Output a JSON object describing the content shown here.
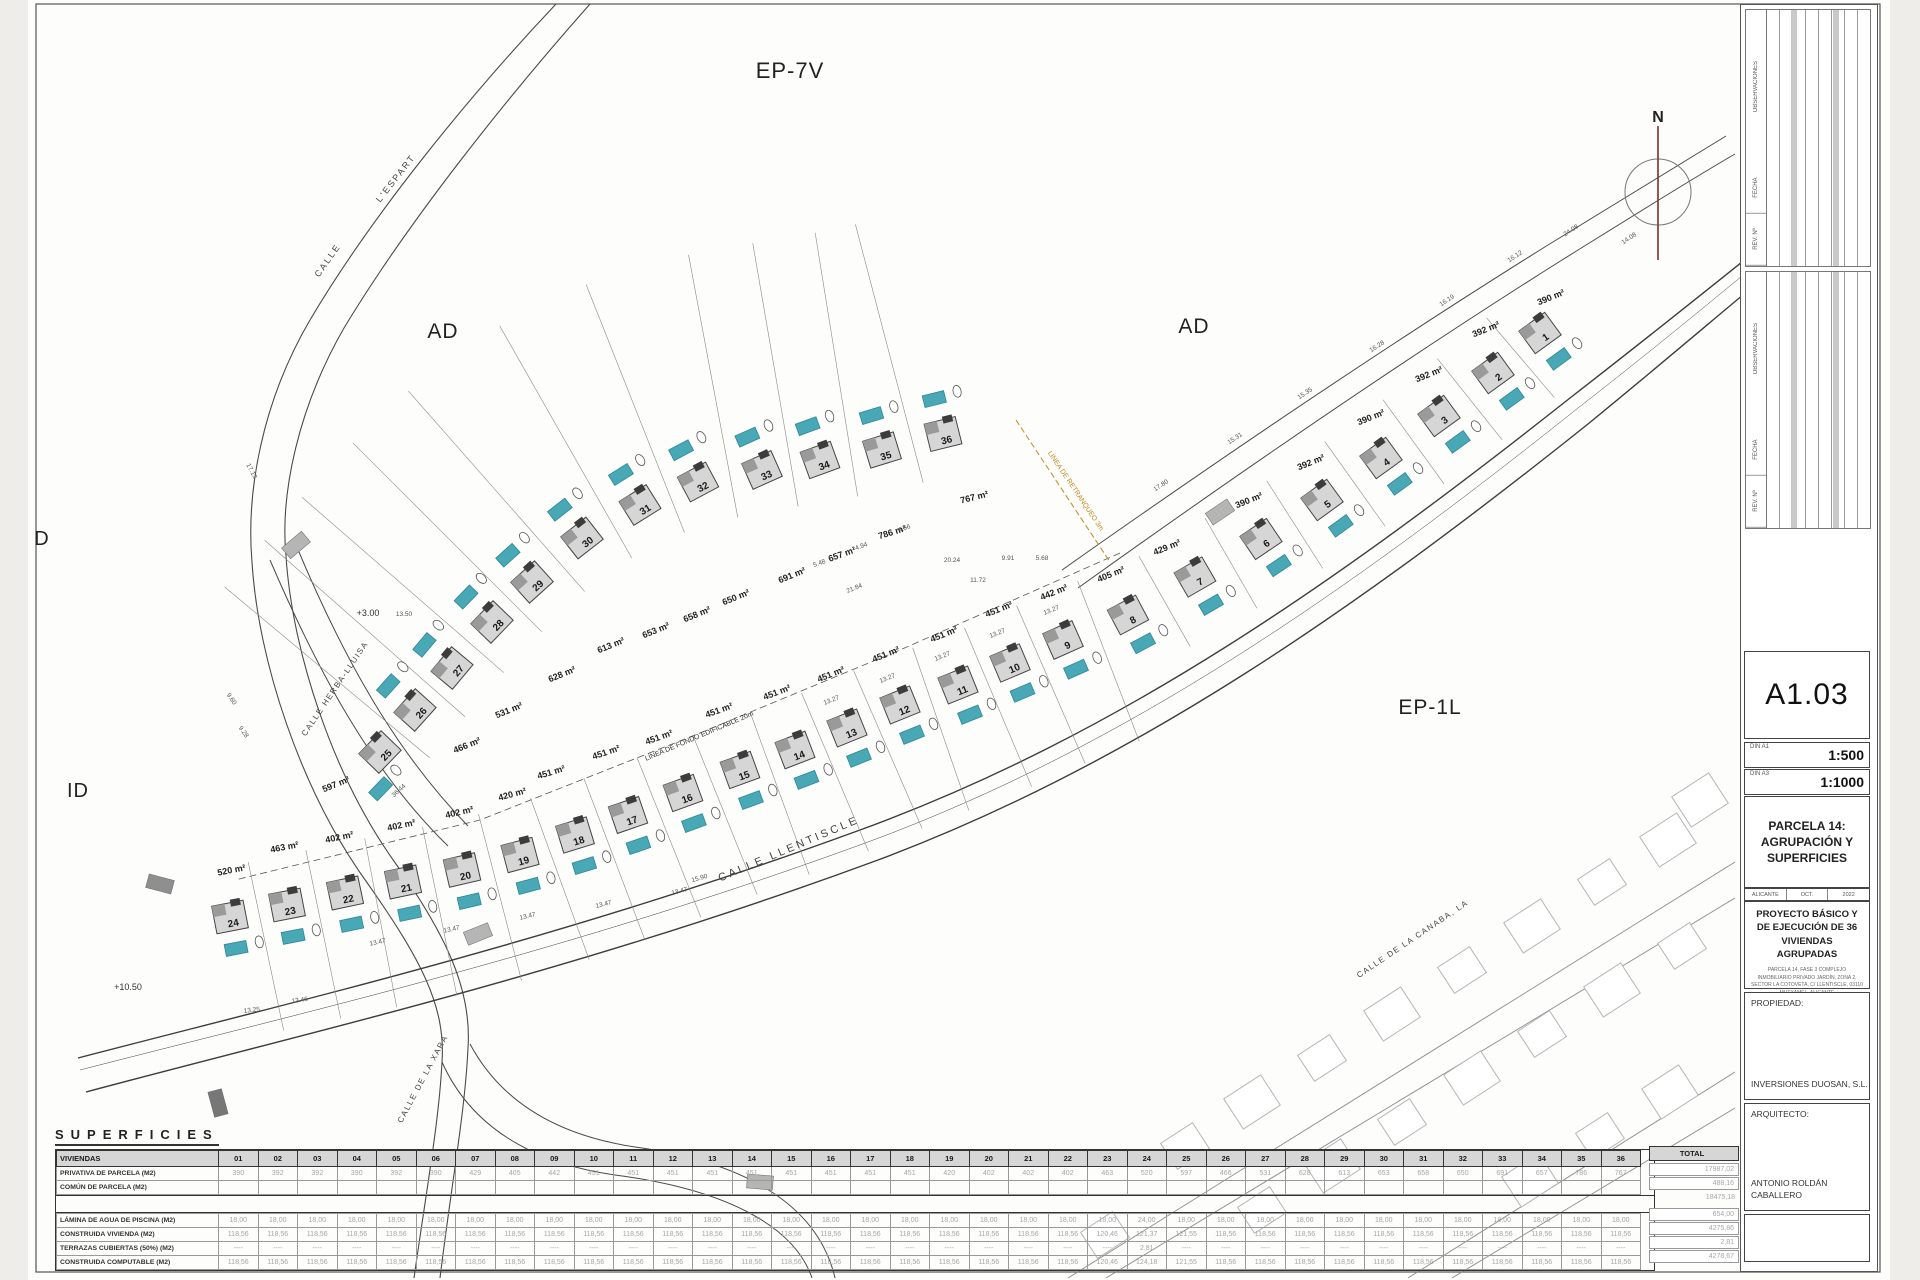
{
  "sheet": {
    "code": "A1.03",
    "format_a1": "DIN A1",
    "scale_a1": "1:500",
    "format_a3": "DIN A3",
    "scale_a3": "1:1000",
    "drawing_title": "PARCELA 14: AGRUPACIÓN Y SUPERFICIES",
    "city": "ALICANTE",
    "month": "OCT.",
    "year": "2022",
    "project": "PROYECTO BÁSICO Y DE EJECUCIÓN DE 36 VIVIENDAS AGRUPADAS",
    "project_detail": "PARCELA 14, FASE 3 COMPLEJO INMOBILIARIO PRIVADO JARDÍN, ZONA 2, SECTOR LA COTOVETA, C/ LLENTISCLE, 03110 MUTXAMEL, ALICANTE",
    "propiedad_label": "PROPIEDAD:",
    "propiedad": "INVERSIONES DUOSAN, S.L.",
    "arquitecto_label": "ARQUITECTO:",
    "arquitecto": "ANTONIO ROLDÁN CABALLERO"
  },
  "north": {
    "label": "N"
  },
  "rev_labels": [
    "OBSERVACIONES",
    "FECHA",
    "REV. Nº"
  ],
  "zones": [
    {
      "label": "EP-7V",
      "x": 790,
      "y": 78,
      "size": 22
    },
    {
      "label": "AD",
      "x": 443,
      "y": 338,
      "size": 21
    },
    {
      "label": "AD",
      "x": 1194,
      "y": 333,
      "size": 21
    },
    {
      "label": "EP-1L",
      "x": 1430,
      "y": 714,
      "size": 21
    },
    {
      "label": "ID",
      "x": 78,
      "y": 797,
      "size": 20
    },
    {
      "label": "D",
      "x": 42,
      "y": 545,
      "size": 20
    }
  ],
  "streets": [
    {
      "label": "CALLE",
      "x": 330,
      "y": 262,
      "r": -55,
      "size": 9,
      "ls": 2
    },
    {
      "label": "L'ESPART",
      "x": 398,
      "y": 180,
      "r": -52,
      "size": 9,
      "ls": 2
    },
    {
      "label": "CALLE HERBA-LLUISA",
      "x": 337,
      "y": 690,
      "r": -56,
      "size": 8,
      "ls": 1.5
    },
    {
      "label": "CALLE LLENTISCLE",
      "x": 790,
      "y": 852,
      "r": -23,
      "size": 11,
      "ls": 3
    },
    {
      "label": "CALLE DE LA XARA",
      "x": 425,
      "y": 1080,
      "r": -62,
      "size": 8,
      "ls": 1.5
    },
    {
      "label": "CALLE DE LA CANABA, LA",
      "x": 1414,
      "y": 941,
      "r": -34,
      "size": 8,
      "ls": 1.5
    }
  ],
  "annotations": {
    "retranqueo": {
      "label": "LÍNEA DE RETRANQUEO 3m",
      "x": 1074,
      "y": 492,
      "r": 56,
      "color": "#bf8a1e"
    },
    "fondo": {
      "label": "LÍNEA DE FONDO EDIFICABLE 20m",
      "x": 700,
      "y": 738,
      "r": -23
    },
    "levels": [
      {
        "label": "+3.00",
        "x": 368,
        "y": 616
      },
      {
        "label": "+10.50",
        "x": 128,
        "y": 990
      }
    ]
  },
  "houses": [
    {
      "n": "1",
      "x": 1540,
      "y": 333,
      "r": -36,
      "p": "s",
      "area": "390 m²",
      "ax": 1552,
      "ay": 300
    },
    {
      "n": "2",
      "x": 1493,
      "y": 373,
      "r": -36,
      "p": "s",
      "area": "392 m²",
      "ax": 1487,
      "ay": 332
    },
    {
      "n": "3",
      "x": 1439,
      "y": 416,
      "r": -36,
      "p": "s",
      "area": "392 m²",
      "ax": 1430,
      "ay": 377
    },
    {
      "n": "4",
      "x": 1381,
      "y": 458,
      "r": -36,
      "p": "s",
      "area": "390 m²",
      "ax": 1372,
      "ay": 420
    },
    {
      "n": "5",
      "x": 1322,
      "y": 500,
      "r": -36,
      "p": "s",
      "area": "392 m²",
      "ax": 1312,
      "ay": 465
    },
    {
      "n": "6",
      "x": 1261,
      "y": 539,
      "r": -34,
      "p": "s",
      "area": "390 m²",
      "ax": 1250,
      "ay": 503
    },
    {
      "n": "7",
      "x": 1195,
      "y": 577,
      "r": -30,
      "p": "s",
      "area": "429 m²",
      "ax": 1168,
      "ay": 550
    },
    {
      "n": "8",
      "x": 1128,
      "y": 615,
      "r": -28,
      "p": "s",
      "area": "405 m²",
      "ax": 1112,
      "ay": 577
    },
    {
      "n": "9",
      "x": 1063,
      "y": 640,
      "r": -24,
      "p": "s",
      "area": "442 m²",
      "ax": 1055,
      "ay": 595
    },
    {
      "n": "10",
      "x": 1010,
      "y": 663,
      "r": -23,
      "p": "s",
      "area": "451 m²",
      "ax": 1000,
      "ay": 612
    },
    {
      "n": "11",
      "x": 958,
      "y": 685,
      "r": -22,
      "p": "s",
      "area": "451 m²",
      "ax": 945,
      "ay": 637
    },
    {
      "n": "12",
      "x": 900,
      "y": 705,
      "r": -22,
      "p": "s",
      "area": "451 m²",
      "ax": 887,
      "ay": 657
    },
    {
      "n": "13",
      "x": 847,
      "y": 728,
      "r": -22,
      "p": "s",
      "area": "451 m²",
      "ax": 832,
      "ay": 677
    },
    {
      "n": "14",
      "x": 795,
      "y": 750,
      "r": -21,
      "p": "s",
      "area": "451 m²",
      "ax": 778,
      "ay": 695
    },
    {
      "n": "15",
      "x": 740,
      "y": 770,
      "r": -20,
      "p": "s",
      "area": "451 m²",
      "ax": 720,
      "ay": 713
    },
    {
      "n": "16",
      "x": 683,
      "y": 793,
      "r": -20,
      "p": "s",
      "area": "451 m²",
      "ax": 660,
      "ay": 740
    },
    {
      "n": "17",
      "x": 628,
      "y": 815,
      "r": -19,
      "p": "s",
      "area": "451 m²",
      "ax": 607,
      "ay": 755
    },
    {
      "n": "18",
      "x": 575,
      "y": 835,
      "r": -17,
      "p": "s",
      "area": "451 m²",
      "ax": 552,
      "ay": 775
    },
    {
      "n": "19",
      "x": 520,
      "y": 855,
      "r": -15,
      "p": "s",
      "area": "420 m²",
      "ax": 513,
      "ay": 797
    },
    {
      "n": "20",
      "x": 462,
      "y": 870,
      "r": -13,
      "p": "s",
      "area": "402 m²",
      "ax": 460,
      "ay": 815
    },
    {
      "n": "21",
      "x": 403,
      "y": 882,
      "r": -12,
      "p": "s",
      "area": "402 m²",
      "ax": 402,
      "ay": 828
    },
    {
      "n": "22",
      "x": 345,
      "y": 893,
      "r": -12,
      "p": "s",
      "area": "402 m²",
      "ax": 340,
      "ay": 840
    },
    {
      "n": "23",
      "x": 287,
      "y": 905,
      "r": -11,
      "p": "s",
      "area": "463 m²",
      "ax": 285,
      "ay": 850
    },
    {
      "n": "24",
      "x": 230,
      "y": 917,
      "r": -11,
      "p": "s",
      "area": "520 m²",
      "ax": 232,
      "ay": 873
    },
    {
      "n": "25",
      "x": 380,
      "y": 752,
      "r": -46,
      "p": "sw",
      "area": "597 m²",
      "ax": 337,
      "ay": 787
    },
    {
      "n": "26",
      "x": 415,
      "y": 710,
      "r": -48,
      "p": "nw",
      "area": "466 m²",
      "ax": 468,
      "ay": 748
    },
    {
      "n": "27",
      "x": 452,
      "y": 668,
      "r": -50,
      "p": "nw",
      "area": "531 m²",
      "ax": 510,
      "ay": 713
    },
    {
      "n": "28",
      "x": 492,
      "y": 622,
      "r": -46,
      "p": "nw",
      "area": "628 m²",
      "ax": 563,
      "ay": 677
    },
    {
      "n": "29",
      "x": 532,
      "y": 582,
      "r": -42,
      "p": "nw",
      "area": "613 m²",
      "ax": 612,
      "ay": 648
    },
    {
      "n": "30",
      "x": 582,
      "y": 538,
      "r": -38,
      "p": "nw",
      "area": "653 m²",
      "ax": 657,
      "ay": 633
    },
    {
      "n": "31",
      "x": 640,
      "y": 505,
      "r": -32,
      "p": "nw",
      "area": "658 m²",
      "ax": 698,
      "ay": 617
    },
    {
      "n": "32",
      "x": 698,
      "y": 482,
      "r": -28,
      "p": "nw",
      "area": "650 m²",
      "ax": 737,
      "ay": 600
    },
    {
      "n": "33",
      "x": 762,
      "y": 470,
      "r": -24,
      "p": "nw",
      "area": "691 m²",
      "ax": 793,
      "ay": 578
    },
    {
      "n": "34",
      "x": 820,
      "y": 460,
      "r": -20,
      "p": "nw",
      "area": "657 m²",
      "ax": 843,
      "ay": 557
    },
    {
      "n": "35",
      "x": 882,
      "y": 450,
      "r": -17,
      "p": "nw",
      "area": "786 m²",
      "ax": 893,
      "ay": 535
    },
    {
      "n": "36",
      "x": 943,
      "y": 434,
      "r": -14,
      "p": "nw",
      "area": "767 m²",
      "ax": 975,
      "ay": 500
    }
  ],
  "dims": [
    {
      "t": "13.47",
      "x": 378,
      "y": 944,
      "r": -12
    },
    {
      "t": "13.47",
      "x": 452,
      "y": 931,
      "r": -12
    },
    {
      "t": "13.47",
      "x": 528,
      "y": 918,
      "r": -13
    },
    {
      "t": "13.47",
      "x": 604,
      "y": 906,
      "r": -14
    },
    {
      "t": "13.47",
      "x": 680,
      "y": 893,
      "r": -15
    },
    {
      "t": "13.46",
      "x": 300,
      "y": 1002,
      "r": -8
    },
    {
      "t": "13.25",
      "x": 252,
      "y": 1012,
      "r": -6
    },
    {
      "t": "15.90",
      "x": 700,
      "y": 880,
      "r": -16
    },
    {
      "t": "13.27",
      "x": 832,
      "y": 702,
      "r": -22
    },
    {
      "t": "13.27",
      "x": 888,
      "y": 680,
      "r": -22
    },
    {
      "t": "13.27",
      "x": 943,
      "y": 658,
      "r": -22
    },
    {
      "t": "13.27",
      "x": 998,
      "y": 635,
      "r": -22
    },
    {
      "t": "13.27",
      "x": 1052,
      "y": 612,
      "r": -22
    },
    {
      "t": "16.12",
      "x": 1516,
      "y": 258,
      "r": -34
    },
    {
      "t": "16.19",
      "x": 1448,
      "y": 302,
      "r": -34
    },
    {
      "t": "16.28",
      "x": 1378,
      "y": 348,
      "r": -34
    },
    {
      "t": "15.35",
      "x": 1306,
      "y": 395,
      "r": -34
    },
    {
      "t": "15.31",
      "x": 1236,
      "y": 440,
      "r": -34
    },
    {
      "t": "17.80",
      "x": 1162,
      "y": 487,
      "r": -34
    },
    {
      "t": "24.08",
      "x": 1572,
      "y": 232,
      "r": -34
    },
    {
      "t": "14.08",
      "x": 1630,
      "y": 240,
      "r": -34
    },
    {
      "t": "20.24",
      "x": 952,
      "y": 562,
      "r": 0
    },
    {
      "t": "9.91",
      "x": 1008,
      "y": 560,
      "r": 0
    },
    {
      "t": "5.68",
      "x": 1042,
      "y": 560,
      "r": 0
    },
    {
      "t": "11.72",
      "x": 978,
      "y": 582,
      "r": 0
    },
    {
      "t": "21.84",
      "x": 855,
      "y": 590,
      "r": -22
    },
    {
      "t": "36.44",
      "x": 400,
      "y": 792,
      "r": -42
    },
    {
      "t": "13.50",
      "x": 404,
      "y": 616,
      "r": 0
    },
    {
      "t": "4.56",
      "x": 905,
      "y": 530,
      "r": -20
    },
    {
      "t": "4.94",
      "x": 862,
      "y": 548,
      "r": -20
    },
    {
      "t": "5.48",
      "x": 820,
      "y": 565,
      "r": -20
    },
    {
      "t": "9.28",
      "x": 242,
      "y": 733,
      "r": 55
    },
    {
      "t": "9.60",
      "x": 230,
      "y": 700,
      "r": 55
    },
    {
      "t": "17.13",
      "x": 250,
      "y": 472,
      "r": 62
    }
  ],
  "table": {
    "title": "SUPERFICIES",
    "header_label": "VIVIENDAS",
    "total_label": "TOTAL",
    "columns": [
      "01",
      "02",
      "03",
      "04",
      "05",
      "06",
      "07",
      "08",
      "09",
      "10",
      "11",
      "12",
      "13",
      "14",
      "15",
      "16",
      "17",
      "18",
      "19",
      "20",
      "21",
      "22",
      "23",
      "24",
      "25",
      "26",
      "27",
      "28",
      "29",
      "30",
      "31",
      "32",
      "33",
      "34",
      "35",
      "36"
    ],
    "rows": [
      {
        "label": "PRIVATIVA DE PARCELA (M2)",
        "total": "17987,02",
        "values": [
          "390",
          "392",
          "392",
          "390",
          "392",
          "390",
          "429",
          "405",
          "442",
          "451",
          "451",
          "451",
          "451",
          "451",
          "451",
          "451",
          "451",
          "451",
          "420",
          "402",
          "402",
          "402",
          "463",
          "520",
          "597",
          "466",
          "531",
          "628",
          "613",
          "653",
          "658",
          "650",
          "691",
          "657",
          "786",
          "767"
        ]
      },
      {
        "label": "COMÚN DE PARCELA (M2)",
        "total": "488,16",
        "values": [
          "",
          "",
          "",
          "",
          "",
          "",
          "",
          "",
          "",
          "",
          "",
          "",
          "",
          "",
          "",
          "",
          "",
          "",
          "",
          "",
          "",
          "",
          "",
          "",
          "",
          "",
          "",
          "",
          "",
          "",
          "",
          "",
          "",
          "",
          "",
          ""
        ]
      }
    ],
    "subtotal": "18475,18",
    "rows2": [
      {
        "label": "LÁMINA DE AGUA DE PISCINA (M2)",
        "total": "654,00",
        "values": [
          "18,00",
          "18,00",
          "18,00",
          "18,00",
          "18,00",
          "18,00",
          "18,00",
          "18,00",
          "18,00",
          "18,00",
          "18,00",
          "18,00",
          "18,00",
          "18,00",
          "18,00",
          "18,00",
          "18,00",
          "18,00",
          "18,00",
          "18,00",
          "18,00",
          "18,00",
          "18,00",
          "24,00",
          "18,00",
          "18,00",
          "18,00",
          "18,00",
          "18,00",
          "18,00",
          "18,00",
          "18,00",
          "18,00",
          "18,00",
          "18,00",
          "18,00"
        ]
      },
      {
        "label": "CONSTRUIDA VIVIENDA (M2)",
        "total": "4275,86",
        "values": [
          "118,56",
          "118,56",
          "118,56",
          "118,56",
          "118,56",
          "118,56",
          "118,56",
          "118,56",
          "118,56",
          "118,56",
          "118,56",
          "118,56",
          "118,56",
          "118,56",
          "118,56",
          "118,56",
          "118,56",
          "118,56",
          "118,56",
          "118,56",
          "118,56",
          "118,56",
          "120,46",
          "121,37",
          "121,55",
          "118,56",
          "118,56",
          "118,56",
          "118,56",
          "118,56",
          "118,56",
          "118,56",
          "118,56",
          "118,56",
          "118,56",
          "118,56"
        ]
      },
      {
        "label": "TERRAZAS CUBIERTAS (50%) (M2)",
        "total": "2,81",
        "values": [
          "----",
          "----",
          "----",
          "----",
          "----",
          "----",
          "----",
          "----",
          "----",
          "----",
          "----",
          "----",
          "----",
          "----",
          "----",
          "----",
          "----",
          "----",
          "----",
          "----",
          "----",
          "----",
          "----",
          "2,81",
          "----",
          "----",
          "----",
          "----",
          "----",
          "----",
          "----",
          "----",
          "----",
          "----",
          "----",
          "----"
        ]
      },
      {
        "label": "CONSTRUIDA COMPUTABLE (M2)",
        "total": "4278,67",
        "values": [
          "118,56",
          "118,56",
          "118,56",
          "118,56",
          "118,56",
          "118,56",
          "118,56",
          "118,56",
          "118,56",
          "118,56",
          "118,56",
          "118,56",
          "118,56",
          "118,56",
          "118,56",
          "118,56",
          "118,56",
          "118,56",
          "118,56",
          "118,56",
          "118,56",
          "118,56",
          "120,46",
          "124,18",
          "121,55",
          "118,56",
          "118,56",
          "118,56",
          "118,56",
          "118,56",
          "118,56",
          "118,56",
          "118,56",
          "118,56",
          "118,56",
          "118,56"
        ]
      }
    ]
  },
  "existing_houses": [
    {
      "x": 1185,
      "y": 1146
    },
    {
      "x": 1252,
      "y": 1102
    },
    {
      "x": 1322,
      "y": 1058
    },
    {
      "x": 1392,
      "y": 1014
    },
    {
      "x": 1462,
      "y": 970
    },
    {
      "x": 1532,
      "y": 926
    },
    {
      "x": 1602,
      "y": 882
    },
    {
      "x": 1668,
      "y": 840
    },
    {
      "x": 1262,
      "y": 1210
    },
    {
      "x": 1332,
      "y": 1166
    },
    {
      "x": 1402,
      "y": 1122
    },
    {
      "x": 1472,
      "y": 1078
    },
    {
      "x": 1542,
      "y": 1034
    },
    {
      "x": 1612,
      "y": 990
    },
    {
      "x": 1682,
      "y": 946
    },
    {
      "x": 1530,
      "y": 1180
    },
    {
      "x": 1600,
      "y": 1136
    },
    {
      "x": 1670,
      "y": 1092
    },
    {
      "x": 1105,
      "y": 1235
    },
    {
      "x": 1700,
      "y": 800
    }
  ],
  "crosswalks": [
    {
      "x": 296,
      "y": 545,
      "r": -40,
      "c": "#b5b5b5"
    },
    {
      "x": 160,
      "y": 884,
      "r": 15,
      "c": "#8f8f8f"
    },
    {
      "x": 478,
      "y": 934,
      "r": -22,
      "c": "#b5b5b5"
    },
    {
      "x": 218,
      "y": 1103,
      "r": 75,
      "c": "#777777"
    },
    {
      "x": 1220,
      "y": 512,
      "r": -34,
      "c": "#b5b5b5"
    },
    {
      "x": 760,
      "y": 1182,
      "r": 5,
      "c": "#b5b5b5"
    }
  ],
  "colors": {
    "pool": "#49a8b6",
    "pool_edge": "#2e8796",
    "house_fill": "#d6d6d6",
    "house_edge": "#444444",
    "house_dark": "#3c3c3c",
    "line": "#4a4a4a",
    "thin": "#8a8a8a",
    "existing": "#b5b5b5",
    "retranqueo": "#bf8a1e",
    "north_line": "#7a3030"
  }
}
